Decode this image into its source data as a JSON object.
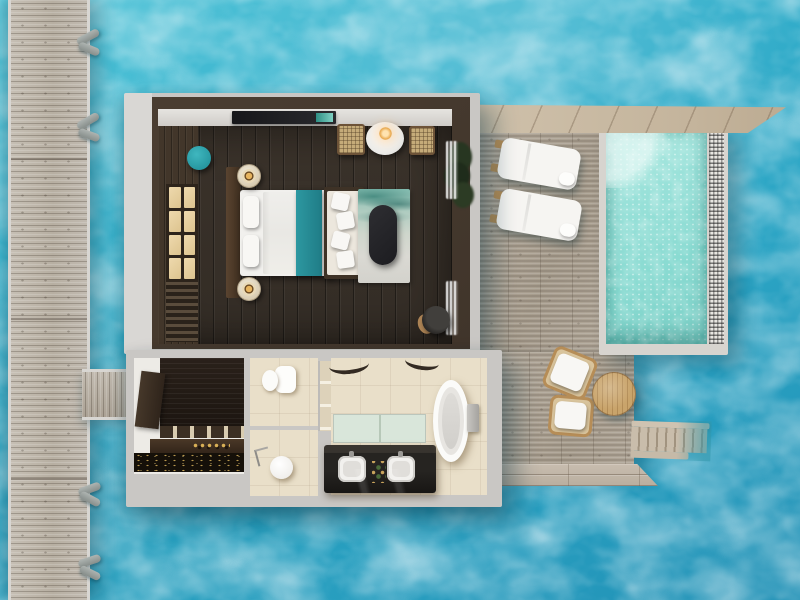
{
  "scene": {
    "title": "Overwater villa floor plan - top-down 3D render",
    "view": "top-down",
    "setting": "turquoise lagoon water",
    "rooms": [
      {
        "name": "bedroom",
        "flooring": "dark timber",
        "furniture": [
          "king bed",
          "headboard",
          "nightstand with lamp",
          "nightstand with lamp",
          "bench with pillows",
          "marbled rug",
          "dark oval coffee table",
          "teal pouf",
          "shoji wardrobe",
          "TV console",
          "rattan chair",
          "rattan chair",
          "round dining table",
          "pendant lamp",
          "potted plant",
          "sheer curtains",
          "sun hat"
        ]
      },
      {
        "name": "dressing-room",
        "flooring": "white",
        "furniture": [
          "wardrobe door panel",
          "dark wardrobe bay",
          "slatted bench",
          "counter with perfume bottles",
          "dark marble counter"
        ]
      },
      {
        "name": "toilet-room",
        "flooring": "beige tile",
        "furniture": [
          "toilet"
        ]
      },
      {
        "name": "shower-room",
        "flooring": "beige tile",
        "furniture": [
          "round shower stool",
          "shower fixture"
        ]
      },
      {
        "name": "main-bathroom",
        "flooring": "beige tile",
        "furniture": [
          "double vanity with two sinks",
          "frosted glass partition",
          "freestanding oval bathtub",
          "floor-standing tub faucet",
          "arched decor beams"
        ]
      }
    ],
    "exterior": [
      {
        "name": "jetty",
        "description": "wooden boardwalk with mooring posts"
      },
      {
        "name": "connector-walkway",
        "description": "short bridge from jetty to villa"
      },
      {
        "name": "sun-deck",
        "furniture": [
          "sun lounger",
          "sun lounger",
          "lounge chair",
          "lounge chair",
          "round wooden table"
        ]
      },
      {
        "name": "plunge-pool",
        "description": "aqua pool with mosaic edge and corner step"
      },
      {
        "name": "water-steps",
        "description": "wooden stairs descending into lagoon"
      },
      {
        "name": "top-boardwalk",
        "description": "angled plank walkway over pool"
      }
    ]
  },
  "palette": {
    "water_light": "#4fc3d7",
    "water": "#35b0cc",
    "water_mid": "#2ba4c4",
    "water_deep": "#2191b6",
    "wall": "#c9c7c4",
    "wall_dark": "#4a3d31",
    "floor_dark": "#362f28",
    "sand_floor": "#e9dfc9",
    "deck_wood": "#ada393",
    "jetty_wood": "#bdb6ab",
    "strip_wood": "#c6b69e",
    "pool_water": "#8fdcd4",
    "teal_accent": "#2a9fa9",
    "lamp_gold": "#c0883e",
    "linen_white": "#f4f3f0",
    "vanity_black": "#262421",
    "marble_black": "#161009"
  }
}
